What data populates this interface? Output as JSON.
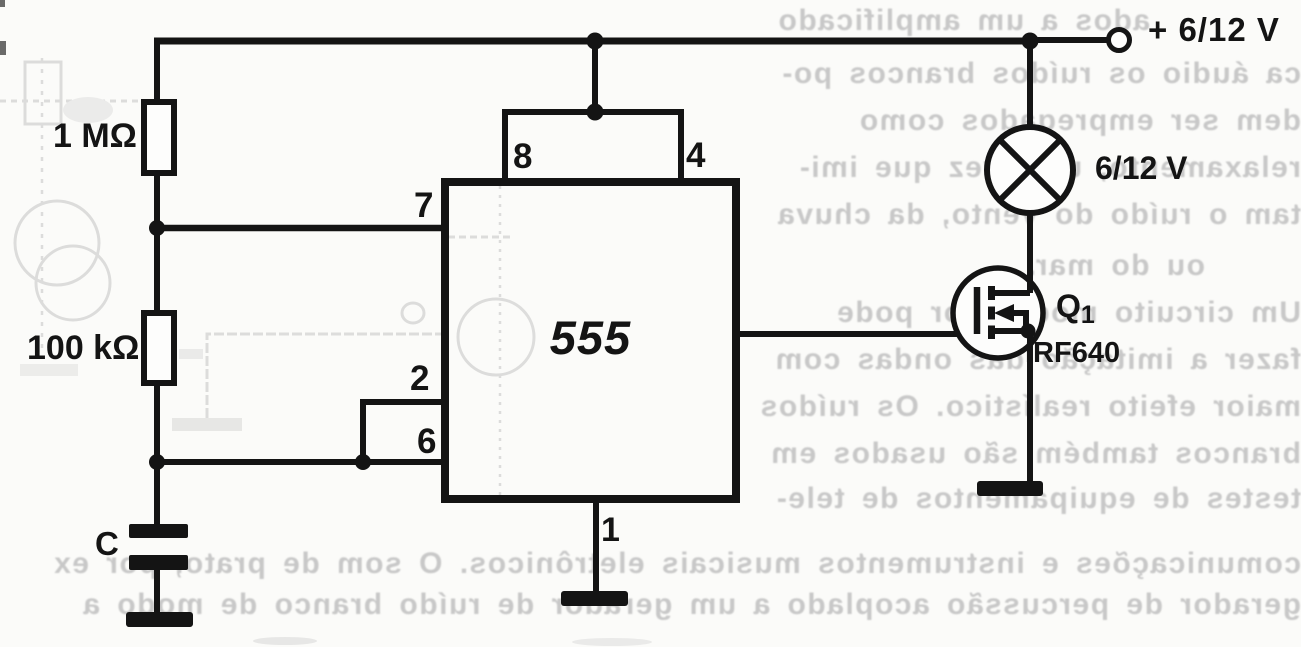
{
  "schematic": {
    "ic_label": "555",
    "power_label": "+ 6/12 V",
    "lamp_label": "6/12 V",
    "transistor_ref": "Q",
    "transistor_ref_sub": "1",
    "transistor_part": "IRF640",
    "r1_label": "1 MΩ",
    "r2_label": "100 kΩ",
    "cap_label": "C",
    "pins": {
      "p1": "1",
      "p2": "2",
      "p4": "4",
      "p6": "6",
      "p7": "7",
      "p8": "8"
    }
  },
  "bleed_text": {
    "right_column": [
      "ados a um amplificado",
      "ca áudio os ruídos brancos po-",
      "dem ser empregados como",
      "relaxamento, uma vez que imi-",
      "tam o ruído do vento, da chuva",
      "ou do mar.",
      "Um circuito modulador pode",
      "fazer a imitação das ondas com",
      "maior efeito realístico. Os ruídos",
      "brancos também são usados em",
      "testes de equipamentos de tele-"
    ],
    "bottom": [
      "comunicações e instrumentos musicais eletrônicos. O som de prato, por ex",
      "gerador de percussão acoplado a um gerador de ruído branco de modo a"
    ]
  },
  "colors": {
    "ink": "#141414",
    "ghost": "#c4c4c4",
    "paper": "#fbfbf9"
  }
}
